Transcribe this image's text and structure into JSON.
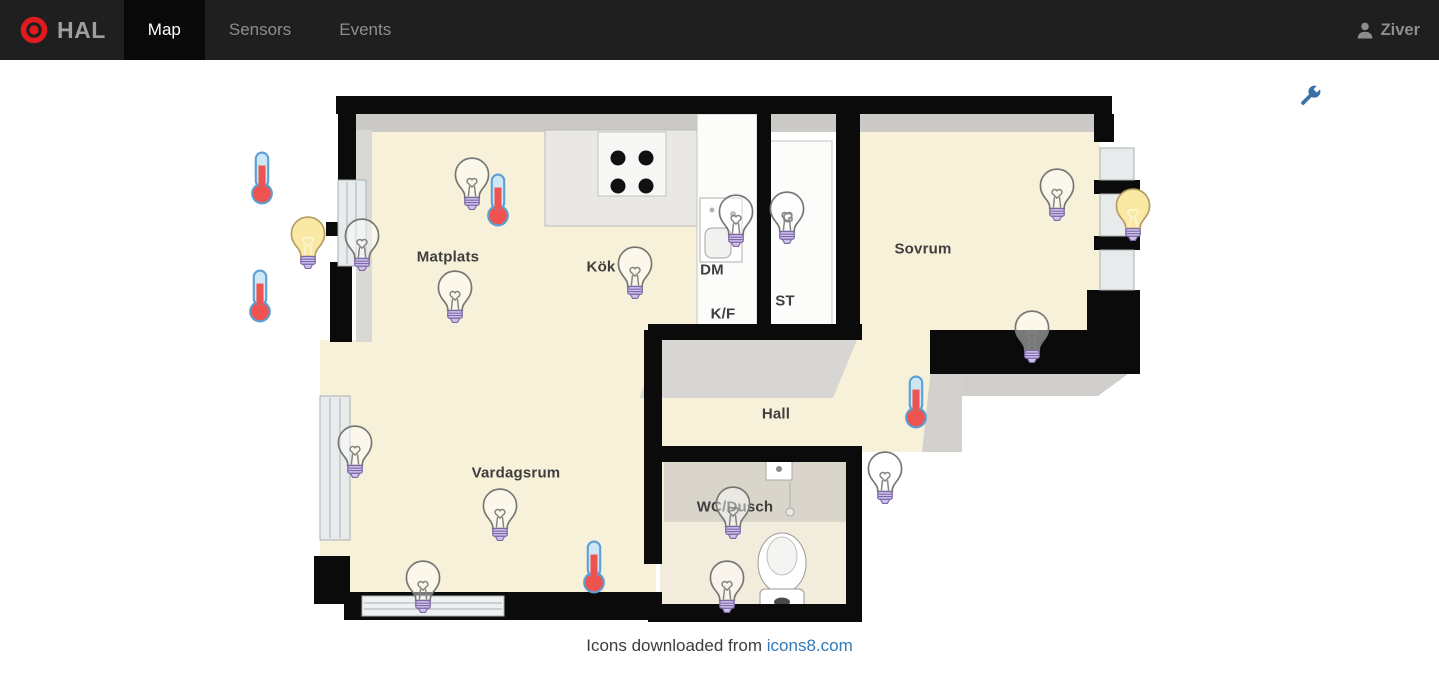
{
  "navbar": {
    "brand": "HAL",
    "tabs": [
      {
        "label": "Map",
        "active": true
      },
      {
        "label": "Sensors",
        "active": false
      },
      {
        "label": "Events",
        "active": false
      }
    ],
    "user": "Ziver"
  },
  "toolbar": {
    "wrench_icon": "settings-wrench"
  },
  "map": {
    "rooms": [
      {
        "label": "Matplats",
        "x": 448,
        "y": 257
      },
      {
        "label": "Kök",
        "x": 601,
        "y": 267
      },
      {
        "label": "DM",
        "x": 712,
        "y": 270
      },
      {
        "label": "K/F",
        "x": 723,
        "y": 314
      },
      {
        "label": "ST",
        "x": 785,
        "y": 301
      },
      {
        "label": "G",
        "x": 788,
        "y": 218
      },
      {
        "label": "Sovrum",
        "x": 923,
        "y": 249
      },
      {
        "label": "Hall",
        "x": 776,
        "y": 414
      },
      {
        "label": "Vardagsrum",
        "x": 516,
        "y": 473
      },
      {
        "label": "WC/Dusch",
        "x": 735,
        "y": 507
      }
    ],
    "devices": [
      {
        "type": "bulb",
        "state": "off",
        "x": 472,
        "y": 183
      },
      {
        "type": "bulb",
        "state": "on",
        "x": 308,
        "y": 242
      },
      {
        "type": "bulb",
        "state": "off",
        "x": 362,
        "y": 244
      },
      {
        "type": "bulb",
        "state": "off",
        "x": 455,
        "y": 296
      },
      {
        "type": "bulb",
        "state": "off",
        "x": 635,
        "y": 272
      },
      {
        "type": "bulb",
        "state": "off",
        "x": 736,
        "y": 220
      },
      {
        "type": "bulb",
        "state": "off",
        "x": 787,
        "y": 217
      },
      {
        "type": "bulb",
        "state": "off",
        "x": 1057,
        "y": 194
      },
      {
        "type": "bulb",
        "state": "on",
        "x": 1133,
        "y": 214
      },
      {
        "type": "bulb",
        "state": "off",
        "x": 1032,
        "y": 336
      },
      {
        "type": "bulb",
        "state": "off",
        "x": 885,
        "y": 477
      },
      {
        "type": "bulb",
        "state": "off",
        "x": 355,
        "y": 451
      },
      {
        "type": "bulb",
        "state": "off",
        "x": 500,
        "y": 514
      },
      {
        "type": "bulb",
        "state": "off",
        "x": 423,
        "y": 586
      },
      {
        "type": "bulb",
        "state": "off",
        "x": 733,
        "y": 512
      },
      {
        "type": "bulb",
        "state": "off",
        "x": 727,
        "y": 586
      },
      {
        "type": "thermometer",
        "state": "",
        "x": 262,
        "y": 178
      },
      {
        "type": "thermometer",
        "state": "",
        "x": 260,
        "y": 296
      },
      {
        "type": "thermometer",
        "state": "",
        "x": 498,
        "y": 200
      },
      {
        "type": "thermometer",
        "state": "",
        "x": 916,
        "y": 402
      },
      {
        "type": "thermometer",
        "state": "",
        "x": 594,
        "y": 567
      }
    ]
  },
  "footer": {
    "text": "Icons downloaded from",
    "link_text": "icons8.com"
  },
  "colors": {
    "navbar_bg": "#1f1f1f",
    "navbar_active_bg": "#090909",
    "brand_red": "#e01b1f",
    "brand_text": "#9e9e9e",
    "nav_text": "#8d8d8d",
    "active_text": "#ffffff",
    "link_blue": "#337ab7",
    "wrench_blue": "#3a72a8",
    "floor_beige": "#f8f1da",
    "wall_black": "#0b0b0b",
    "face_gray": "#cbcac6",
    "bulb_on_fill": "#fae9a4",
    "bulb_base": "#cfc3eb",
    "bulb_base_stroke": "#7b68a8",
    "therm_red": "#ee5350",
    "therm_tube": "#cde7f6",
    "therm_stroke": "#5b9fd4"
  }
}
